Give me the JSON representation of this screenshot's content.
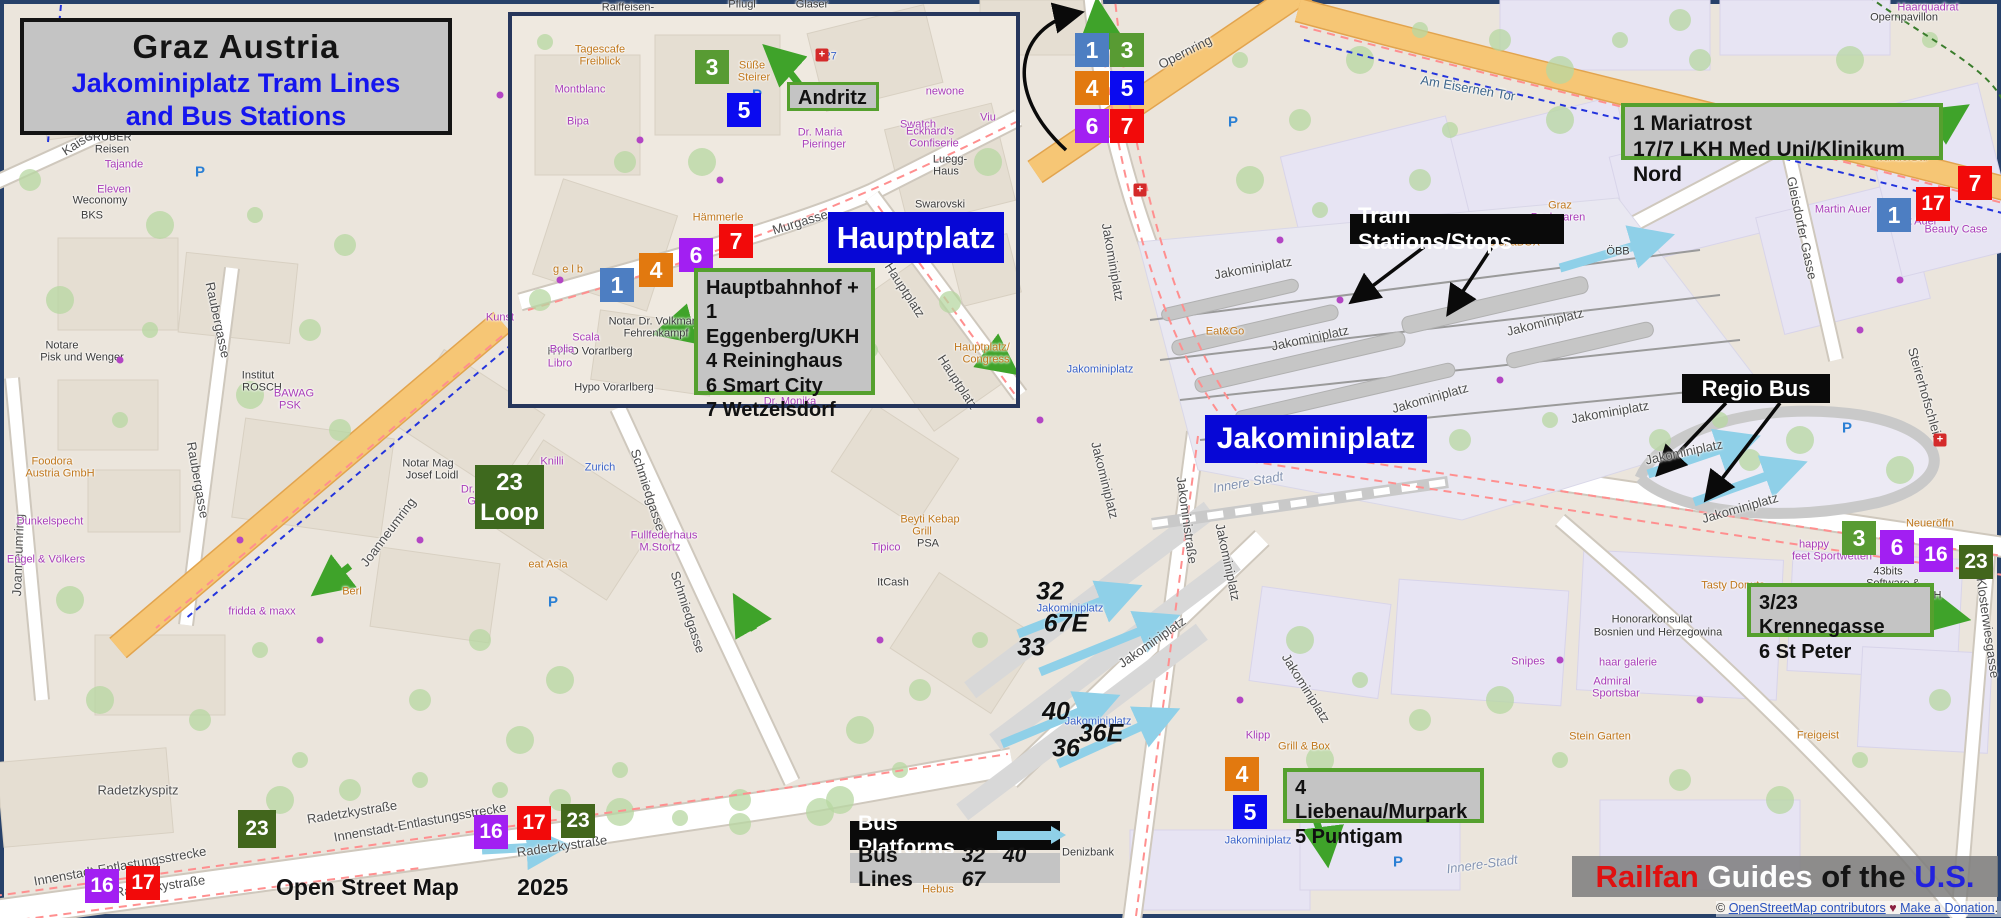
{
  "title": {
    "line1": "Graz  Austria",
    "line2": "Jakominiplatz Tram Lines",
    "line3": "and Bus Stations"
  },
  "labels": {
    "andritz": "Andritz",
    "hauptplatz": "Hauptplatz",
    "jakominiplatz": "Jakominiplatz",
    "tram_stations": "Tram Stations/Stops",
    "regio_bus": "Regio Bus",
    "loop_line1": "23",
    "loop_line2": "Loop",
    "bus_platforms": "Bus Platforms",
    "bus_lines": "Bus Lines",
    "bus_lines_numbers": "32 40 67"
  },
  "info_boxes": {
    "hauptbahnhof": [
      "Hauptbahnhof +",
      "1 Eggenberg/UKH",
      "4 Reininghaus",
      "6 Smart City",
      "7 Wetzelsdorf"
    ],
    "mariatrost": [
      "1 Mariatrost",
      "17/7 LKH Med Uni/Klinikum Nord"
    ],
    "krennegasse": [
      "3/23 Krennegasse",
      "6 St Peter"
    ],
    "liebenau": [
      "4 Liebenau/Murpark",
      "5 Puntigam"
    ]
  },
  "credits": {
    "osm_label": "Open Street Map",
    "osm_year": "2025",
    "railfan": [
      "Railfan",
      " Guides",
      " of the",
      " U.S."
    ],
    "copy_prefix": "© ",
    "link_contributors": "OpenStreetMap contributors",
    "heart": " ♥ ",
    "link_donation": "Make a Donation",
    "copy_suffix": ". W"
  },
  "line_colors": {
    "1": "#4d7ec2",
    "3": "#589b33",
    "4": "#e2790f",
    "5": "#0a0af0",
    "6": "#a21ff2",
    "7": "#f20a0a",
    "16": "#a21ff2",
    "17": "#f20a0a",
    "23": "#42661c"
  },
  "colors": {
    "blue_box": "#0707d6",
    "gray_box": "#c4c4c4",
    "green_border": "#55a02e",
    "black_box": "#0a0a0a",
    "cyan_arrow": "#8fd0e8",
    "green_arrow": "#3fa32a",
    "orange_road": "#f6c675",
    "railfan_red": "#e01010",
    "railfan_blue": "#2222dd"
  },
  "badges": [
    {
      "line": "3",
      "x": 695,
      "y": 50
    },
    {
      "line": "5",
      "x": 727,
      "y": 93
    },
    {
      "line": "1",
      "x": 600,
      "y": 268
    },
    {
      "line": "4",
      "x": 639,
      "y": 253
    },
    {
      "line": "6",
      "x": 679,
      "y": 238
    },
    {
      "line": "7",
      "x": 719,
      "y": 224
    },
    {
      "line": "1",
      "x": 1075,
      "y": 33
    },
    {
      "line": "3",
      "x": 1110,
      "y": 33
    },
    {
      "line": "4",
      "x": 1075,
      "y": 71
    },
    {
      "line": "5",
      "x": 1110,
      "y": 71
    },
    {
      "line": "6",
      "x": 1075,
      "y": 109
    },
    {
      "line": "7",
      "x": 1110,
      "y": 109
    },
    {
      "line": "7",
      "x": 1958,
      "y": 166
    },
    {
      "line": "17",
      "x": 1916,
      "y": 187
    },
    {
      "line": "1",
      "x": 1877,
      "y": 198
    },
    {
      "line": "3",
      "x": 1842,
      "y": 521
    },
    {
      "line": "6",
      "x": 1880,
      "y": 530
    },
    {
      "line": "16",
      "x": 1919,
      "y": 538
    },
    {
      "line": "23",
      "x": 1959,
      "y": 545
    },
    {
      "line": "4",
      "x": 1225,
      "y": 757
    },
    {
      "line": "5",
      "x": 1233,
      "y": 795
    },
    {
      "line": "23",
      "x": 238,
      "y": 810,
      "s": 38
    },
    {
      "line": "16",
      "x": 474,
      "y": 815
    },
    {
      "line": "17",
      "x": 517,
      "y": 806
    },
    {
      "line": "23",
      "x": 561,
      "y": 804
    },
    {
      "line": "16",
      "x": 85,
      "y": 869
    },
    {
      "line": "17",
      "x": 126,
      "y": 866
    }
  ],
  "map": {
    "bus_line_numbers": [
      {
        "t": "32",
        "x": 1050,
        "y": 592
      },
      {
        "t": "67E",
        "x": 1066,
        "y": 624
      },
      {
        "t": "33",
        "x": 1031,
        "y": 648
      },
      {
        "t": "40",
        "x": 1056,
        "y": 712
      },
      {
        "t": "36E",
        "x": 1101,
        "y": 734
      },
      {
        "t": "36",
        "x": 1066,
        "y": 749
      }
    ],
    "street_labels": [
      [
        "Opernring",
        1185,
        52,
        -27,
        "st"
      ],
      [
        "Am Eisernen Tor",
        1468,
        88,
        10,
        "nav"
      ],
      [
        "Haarquadrat",
        1928,
        8,
        0,
        "shop"
      ],
      [
        "Opernpavillon",
        1904,
        18,
        0,
        "st2"
      ],
      [
        "Motel One Graz",
        1752,
        133,
        0,
        "blue"
      ],
      [
        "UI-Die Bar",
        1733,
        122,
        0,
        "food"
      ],
      [
        "wunderBar",
        1902,
        158,
        0,
        "food"
      ],
      [
        "Beauty Case",
        1956,
        230,
        0,
        "shop"
      ],
      [
        "Martin Auer",
        1843,
        210,
        0,
        "shop"
      ],
      [
        "Hubert Auer",
        1908,
        222,
        0,
        "shop"
      ],
      [
        "Backwaren",
        1558,
        218,
        0,
        "shop"
      ],
      [
        "Graz",
        1560,
        206,
        0,
        "food"
      ],
      [
        "SteiraBOX",
        1514,
        243,
        0,
        "food"
      ],
      [
        "ÖBB",
        1618,
        252,
        0,
        "st2"
      ],
      [
        "Gleisdorfer Gasse",
        1802,
        228,
        78,
        "st"
      ],
      [
        "Steirerhofschleife",
        1926,
        396,
        74,
        "st"
      ],
      [
        "Klosterwiesgasse",
        1988,
        628,
        82,
        "st"
      ],
      [
        "Jakominiplatz",
        1113,
        262,
        80,
        "st"
      ],
      [
        "Jakominiplatz",
        1253,
        268,
        -10,
        "st"
      ],
      [
        "Jakominiplatz",
        1310,
        338,
        -12,
        "st"
      ],
      [
        "Jakominiplatz",
        1430,
        398,
        -16,
        "st"
      ],
      [
        "Jakominiplatz",
        1545,
        322,
        -14,
        "st"
      ],
      [
        "Jakominiplatz",
        1610,
        412,
        -10,
        "st"
      ],
      [
        "Jakominiplatz",
        1684,
        452,
        -12,
        "st"
      ],
      [
        "Jakominiplatz",
        1105,
        480,
        76,
        "st"
      ],
      [
        "Jakominiplatz",
        1228,
        562,
        78,
        "st"
      ],
      [
        "Jakominiplatz",
        1152,
        642,
        -35,
        "st"
      ],
      [
        "Jakominiplatz",
        1306,
        688,
        58,
        "st"
      ],
      [
        "Jakominiplatz",
        1740,
        508,
        -16,
        "st"
      ],
      [
        "Jakominiplatz",
        1100,
        370,
        0,
        "blue"
      ],
      [
        "Jakominiplatz",
        1070,
        609,
        0,
        "blue"
      ],
      [
        "Jakominiplatz",
        1098,
        722,
        0,
        "blue"
      ],
      [
        "Jakominiplatz",
        1258,
        841,
        0,
        "blue"
      ],
      [
        "Jakoministraße",
        1187,
        520,
        82,
        "st"
      ],
      [
        "Innere Stadt",
        1248,
        482,
        -10,
        "area"
      ],
      [
        "Innere-Stadt",
        1482,
        864,
        -8,
        "area"
      ],
      [
        "Eat&Go",
        1225,
        332,
        0,
        "food"
      ],
      [
        "Honorarkonsulat",
        1652,
        620,
        0,
        "st2"
      ],
      [
        "Bosnien und Herzegowina",
        1658,
        633,
        0,
        "st2"
      ],
      [
        "Admiral",
        1612,
        682,
        0,
        "shop"
      ],
      [
        "Sportsbar",
        1616,
        694,
        0,
        "shop"
      ],
      [
        "Stein Garten",
        1600,
        737,
        0,
        "food"
      ],
      [
        "Snipes",
        1528,
        662,
        0,
        "shop"
      ],
      [
        "haar galerie",
        1628,
        663,
        0,
        "shop"
      ],
      [
        "Tasty Donuts",
        1733,
        586,
        0,
        "food"
      ],
      [
        "Freigeist",
        1818,
        736,
        0,
        "food"
      ],
      [
        "43bits",
        1888,
        572,
        0,
        "st2"
      ],
      [
        "Software &",
        1893,
        584,
        0,
        "st2"
      ],
      [
        "Consulting GmbH",
        1898,
        596,
        0,
        "st2"
      ],
      [
        "happy",
        1814,
        545,
        0,
        "shop"
      ],
      [
        "feet Sportwetten",
        1832,
        557,
        0,
        "shop"
      ],
      [
        "Neueröffn",
        1930,
        524,
        0,
        "food"
      ],
      [
        "Grill & Box",
        1304,
        747,
        0,
        "food"
      ],
      [
        "Klipp",
        1258,
        736,
        0,
        "shop"
      ],
      [
        "Denizbank",
        1088,
        853,
        0,
        "st2"
      ],
      [
        "Yogg & M",
        1008,
        845,
        0,
        "shop"
      ],
      [
        "mein",
        1032,
        862,
        0,
        "shop"
      ],
      [
        "klein",
        1032,
        872,
        0,
        "shop"
      ],
      [
        "L&A",
        952,
        840,
        0,
        "shop"
      ],
      [
        "Der kleine",
        940,
        880,
        0,
        "food"
      ],
      [
        "Hebus",
        938,
        890,
        0,
        "food"
      ],
      [
        "Radetzkystraße",
        352,
        812,
        -9,
        "st"
      ],
      [
        "Radetzkystraße",
        562,
        846,
        -8,
        "st"
      ],
      [
        "Radetzkystraße",
        160,
        886,
        -8,
        "st"
      ],
      [
        "Innenstadt-Entlastungsstrecke",
        420,
        822,
        -10,
        "st"
      ],
      [
        "Innenstadt-Entlastungsstrecke",
        120,
        866,
        -10,
        "st"
      ],
      [
        "Radetzkyspitz",
        138,
        790,
        0,
        "st"
      ],
      [
        "Schmiedgasse",
        648,
        490,
        72,
        "st"
      ],
      [
        "Schmiedgasse",
        688,
        612,
        72,
        "st"
      ],
      [
        "Joanneumring",
        388,
        532,
        -53,
        "st"
      ],
      [
        "Joanneumring",
        18,
        555,
        -88,
        "st"
      ],
      [
        "Kaiserfeldgasse",
        102,
        127,
        -33,
        "st"
      ],
      [
        "Raubergasse",
        218,
        320,
        78,
        "st"
      ],
      [
        "Raubergasse",
        198,
        480,
        80,
        "st"
      ],
      [
        "GRUBER",
        108,
        138,
        0,
        "st2"
      ],
      [
        "Reisen",
        112,
        150,
        0,
        "st2"
      ],
      [
        "Tajande",
        124,
        165,
        0,
        "shop"
      ],
      [
        "Eleven",
        114,
        190,
        0,
        "shop"
      ],
      [
        "Weconomy",
        100,
        201,
        0,
        "st2"
      ],
      [
        "BKS",
        92,
        216,
        0,
        "st2"
      ],
      [
        "Notare",
        62,
        346,
        0,
        "st2"
      ],
      [
        "Pisk und Wenger",
        82,
        358,
        0,
        "st2"
      ],
      [
        "Institut",
        258,
        376,
        0,
        "st2"
      ],
      [
        "ROSCH",
        262,
        388,
        0,
        "st2"
      ],
      [
        "BAWAG",
        294,
        394,
        0,
        "shop"
      ],
      [
        "PSK",
        290,
        406,
        0,
        "shop"
      ],
      [
        "Foodora",
        52,
        462,
        0,
        "food"
      ],
      [
        "Austria GmbH",
        60,
        474,
        0,
        "food"
      ],
      [
        "Dunkelspecht",
        50,
        522,
        0,
        "shop"
      ],
      [
        "Engel & Völkers",
        46,
        560,
        0,
        "shop"
      ],
      [
        "fridda & maxx",
        262,
        612,
        0,
        "shop"
      ],
      [
        "Berl",
        352,
        592,
        0,
        "food"
      ],
      [
        "eat Asia",
        548,
        565,
        0,
        "food"
      ],
      [
        "Fullfederhaus",
        664,
        536,
        0,
        "shop"
      ],
      [
        "M.Stortz",
        660,
        548,
        0,
        "shop"
      ],
      [
        "Notar Mag",
        428,
        464,
        0,
        "st2"
      ],
      [
        "Josef Loidl",
        432,
        476,
        0,
        "st2"
      ],
      [
        "Dr. Gerald",
        486,
        490,
        0,
        "shop"
      ],
      [
        "Gräscher",
        490,
        502,
        0,
        "shop"
      ],
      [
        "Knilli",
        552,
        462,
        0,
        "shop"
      ],
      [
        "Zurich",
        600,
        468,
        0,
        "blue"
      ],
      [
        "Hypo Vorarlberg",
        614,
        388,
        0,
        "st2"
      ],
      [
        "HYPO Vorarlberg",
        590,
        352,
        0,
        "st2"
      ],
      [
        "Notar Dr. Volkmar",
        652,
        322,
        0,
        "st2"
      ],
      [
        "Fehrenkampf",
        656,
        334,
        0,
        "st2"
      ],
      [
        "Beyti Kebap",
        930,
        520,
        0,
        "food"
      ],
      [
        "Grill",
        922,
        532,
        0,
        "food"
      ],
      [
        "PSA",
        928,
        544,
        0,
        "st2"
      ],
      [
        "Tipico",
        886,
        548,
        0,
        "shop"
      ],
      [
        "ItCash",
        893,
        583,
        0,
        "st2"
      ],
      [
        "Kunst",
        500,
        318,
        0,
        "shop"
      ],
      [
        "Murgasse",
        800,
        222,
        -17,
        "st"
      ],
      [
        "Hauptplatz",
        905,
        290,
        57,
        "st"
      ],
      [
        "Hauptplatz",
        958,
        382,
        57,
        "st"
      ],
      [
        "Hauptplatz/",
        982,
        348,
        0,
        "food"
      ],
      [
        "Congress",
        986,
        360,
        0,
        "food"
      ],
      [
        "Swarovski",
        940,
        205,
        0,
        "st2"
      ],
      [
        "Swatch",
        918,
        125,
        0,
        "shop"
      ],
      [
        "newone",
        945,
        92,
        0,
        "shop"
      ],
      [
        "Dr. Maria",
        820,
        133,
        0,
        "shop"
      ],
      [
        "Pieringer",
        824,
        145,
        0,
        "shop"
      ],
      [
        "Eckhard's",
        930,
        132,
        0,
        "shop"
      ],
      [
        "Confiserie",
        934,
        144,
        0,
        "shop"
      ],
      [
        "Luegg-",
        950,
        160,
        0,
        "st2"
      ],
      [
        "Haus",
        946,
        172,
        0,
        "st2"
      ],
      [
        "Viu",
        988,
        118,
        0,
        "shop"
      ],
      [
        "M27",
        826,
        57,
        0,
        "blue"
      ],
      [
        "Süße",
        752,
        66,
        0,
        "food"
      ],
      [
        "Steirer",
        754,
        78,
        0,
        "food"
      ],
      [
        "Hämmerle",
        718,
        218,
        0,
        "food"
      ],
      [
        "Tagescafe",
        600,
        50,
        0,
        "food"
      ],
      [
        "Freiblick",
        600,
        62,
        0,
        "food"
      ],
      [
        "Montblanc",
        580,
        90,
        0,
        "shop"
      ],
      [
        "Bipa",
        578,
        122,
        0,
        "shop"
      ],
      [
        "DDX",
        706,
        312,
        0,
        "shop"
      ],
      [
        "Scala",
        586,
        338,
        0,
        "shop"
      ],
      [
        "Bolia",
        562,
        350,
        0,
        "shop"
      ],
      [
        "Libro",
        560,
        364,
        0,
        "shop"
      ],
      [
        "Dr. Monika",
        790,
        402,
        0,
        "shop"
      ],
      [
        "Raiffeisen-",
        628,
        8,
        0,
        "st2"
      ],
      [
        "Pflugl",
        742,
        5,
        0,
        "st2"
      ],
      [
        "Glaser",
        812,
        5,
        0,
        "st2"
      ],
      [
        "g e l b",
        568,
        270,
        0,
        "food"
      ]
    ],
    "pois": [
      {
        "t": "P",
        "x": 200,
        "y": 172
      },
      {
        "t": "P",
        "x": 757,
        "y": 95
      },
      {
        "t": "P",
        "x": 292,
        "y": 93
      },
      {
        "t": "P",
        "x": 553,
        "y": 602
      },
      {
        "t": "P",
        "x": 1718,
        "y": 393
      },
      {
        "t": "P",
        "x": 1847,
        "y": 428
      },
      {
        "t": "P",
        "x": 1398,
        "y": 862
      },
      {
        "t": "P",
        "x": 1233,
        "y": 122
      },
      {
        "t": "+",
        "x": 822,
        "y": 55
      },
      {
        "t": "+",
        "x": 1140,
        "y": 190
      },
      {
        "t": "+",
        "x": 1940,
        "y": 440
      },
      {
        "t": "d",
        "x": 500,
        "y": 95
      },
      {
        "t": "d",
        "x": 640,
        "y": 140
      },
      {
        "t": "d",
        "x": 720,
        "y": 180
      },
      {
        "t": "d",
        "x": 560,
        "y": 280
      },
      {
        "t": "d",
        "x": 820,
        "y": 300
      },
      {
        "t": "d",
        "x": 940,
        "y": 240
      },
      {
        "t": "d",
        "x": 1280,
        "y": 240
      },
      {
        "t": "d",
        "x": 1340,
        "y": 300
      },
      {
        "t": "d",
        "x": 1500,
        "y": 380
      },
      {
        "t": "d",
        "x": 1560,
        "y": 660
      },
      {
        "t": "d",
        "x": 1700,
        "y": 700
      },
      {
        "t": "d",
        "x": 240,
        "y": 540
      },
      {
        "t": "d",
        "x": 320,
        "y": 640
      },
      {
        "t": "d",
        "x": 1900,
        "y": 280
      },
      {
        "t": "d",
        "x": 1860,
        "y": 330
      },
      {
        "t": "d",
        "x": 120,
        "y": 360
      },
      {
        "t": "d",
        "x": 420,
        "y": 540
      },
      {
        "t": "d",
        "x": 880,
        "y": 640
      },
      {
        "t": "d",
        "x": 1040,
        "y": 420
      },
      {
        "t": "d",
        "x": 1240,
        "y": 700
      }
    ]
  }
}
